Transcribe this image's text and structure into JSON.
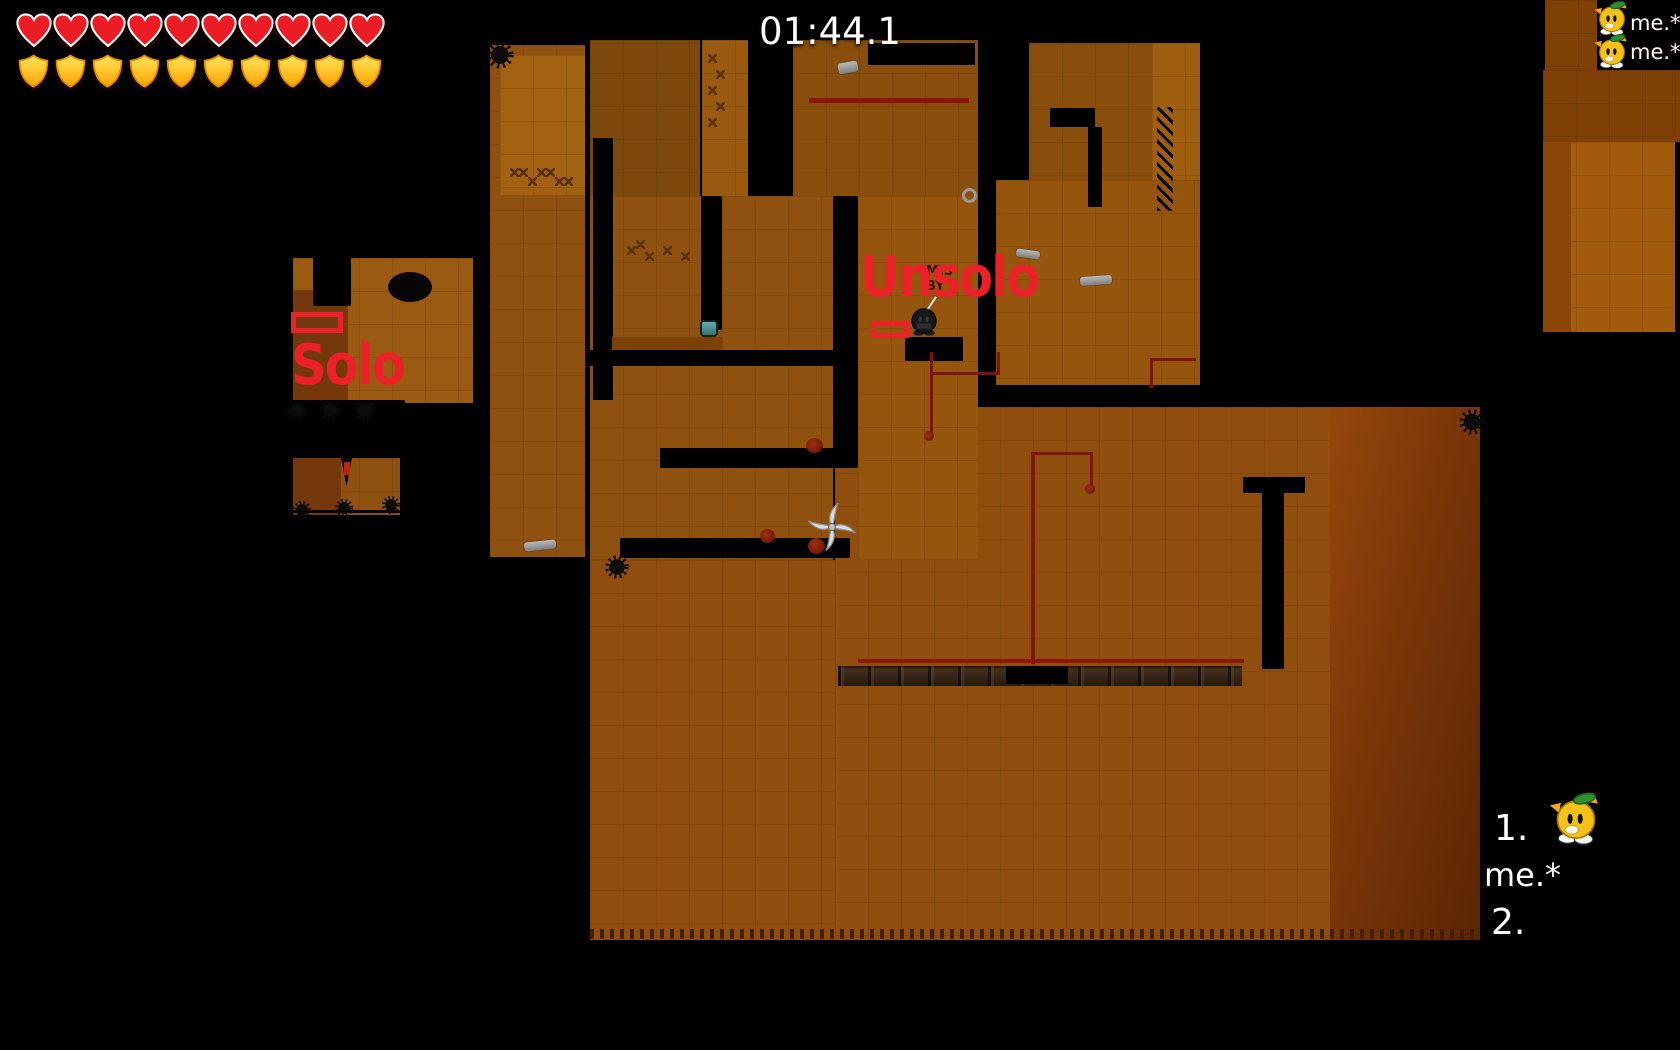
{
  "hud": {
    "health": {
      "count": 10,
      "icon": "heart-icon",
      "color": "#ec1c24"
    },
    "armor": {
      "count": 10,
      "icon": "shield-icon",
      "color": "#ffc200"
    },
    "timer": "01:44.1"
  },
  "nameplates": [
    {
      "name": "me.*"
    },
    {
      "name": "me.*"
    }
  ],
  "world_labels": {
    "solo": "Solo",
    "unsolo": "Unsolo",
    "color": "#ea2127",
    "map_credit": "MIS\nBY"
  },
  "scoreboard": {
    "entries": [
      {
        "rank": "1.",
        "name": "me.*"
      },
      {
        "rank": "2.",
        "name": ""
      }
    ]
  },
  "entities": {
    "shuriken": "ninja-shuriken-icon",
    "pickup": "armor-pickup-icon",
    "dark_player": "dark-tee-with-katana",
    "yellow_player": "cactus-tee"
  },
  "palette": {
    "tile_base": "#8e5110",
    "tile_light": "#a36211",
    "tile_dark": "#7c480c",
    "wire_red": "#7b1600",
    "background": "#000000"
  }
}
